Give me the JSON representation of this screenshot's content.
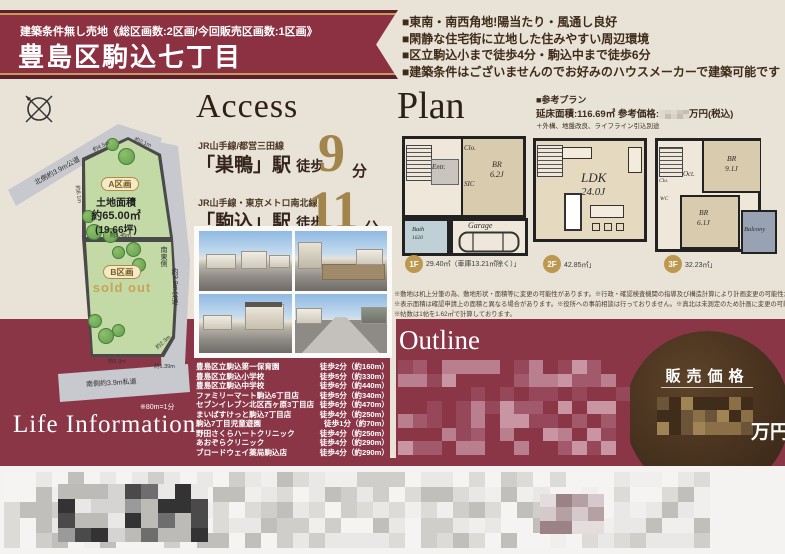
{
  "colors": {
    "maroon": "#8a3647",
    "gold": "#bd9850",
    "beige": "#e9e2d6",
    "text_brown": "#3c2a1d"
  },
  "header": {
    "condition": "建築条件無し売地《総区画数:2区画/今回販売区画数:1区画》",
    "title": "豊島区駒込七丁目"
  },
  "highlights": {
    "items": [
      "■東南・南西角地!陽当たり・風通し良好",
      "■閑静な住宅街に立地した住みやすい周辺環境",
      "■区立駒込小まで徒歩4分・駒込中まで徒歩6分",
      "■建築条件はございませんのでお好みのハウスメーカーで建築可能です"
    ]
  },
  "site_plan": {
    "roads": {
      "north": "北側約3.9m公道",
      "southeast_dir": "南東側",
      "southeast": "約3.8m公道",
      "south": "南側約3.9m私道"
    },
    "plot_a": {
      "badge": "A区画",
      "area_title": "土地面積",
      "area_m2": "約65.00㎡",
      "area_tsubo": "(19.66坪)"
    },
    "plot_b": {
      "badge": "B区画",
      "status": "sold out"
    },
    "dims": {
      "top1": "約4.5m",
      "top2": "約2.1m",
      "left": "約8.1m",
      "divider": "約5.45m",
      "bottom": "約5.3m",
      "corner": "約2.3m",
      "bottom_right": "約1.39m"
    },
    "scale_note": "※80m=1分"
  },
  "access": {
    "title": "Access",
    "stations": [
      {
        "lines": "JR山手線/都営三田線",
        "name": "「巣鴨」駅",
        "walk": "徒歩",
        "minutes": "9",
        "unit": "分"
      },
      {
        "lines": "JR山手線・東京メトロ南北線",
        "name": "「駒込」駅",
        "walk": "徒歩",
        "minutes": "11",
        "unit": "分"
      }
    ]
  },
  "plan": {
    "title": "Plan",
    "reference": {
      "heading": "■参考プラン",
      "area_price": "延床面積:116.69㎡ 参考価格:",
      "price_unit": "万円(税込)",
      "note": "＋外構、地盤改良、ライフライン引込別途"
    },
    "floors": [
      {
        "badge": "1F",
        "area": "29.40㎡（車庫13.21㎡除く）」",
        "rooms": {
          "entr": "Entr.",
          "clo": "Clo.",
          "sic": "SIC",
          "br": "BR",
          "br_size": "6.2J",
          "bath": "Bath",
          "bath_size": "1620",
          "garage": "Garage"
        }
      },
      {
        "badge": "2F",
        "area": "42.85㎡」",
        "rooms": {
          "ldk": "LDK",
          "ldk_size": "24.0J"
        }
      },
      {
        "badge": "3F",
        "area": "32.23㎡」",
        "rooms": {
          "br1": "BR",
          "br1_size": "9.1J",
          "oct": "Oct.",
          "br2": "BR",
          "br2_size": "6.1J",
          "balcony": "Balcony",
          "clo": "Clo.",
          "wc": "WC"
        }
      }
    ],
    "disclaimers": [
      "※敷地は机上分筆の為、敷地形状・面積等に変更の可能性があります。※行政・確認検査機関の指導及び構造計算により計画変更の可能性があります。",
      "※表示面積は確認申請上の面積と異なる場合があります。※役所への事前相談は行っておりません。※真北は未測定のため計画に変更の可能性があります。",
      "※帖数は1帖を1.62㎡で計算しております。"
    ]
  },
  "outline": {
    "title": "Outline"
  },
  "price_circle": {
    "label": "販売価格",
    "unit": "万円"
  },
  "life_information": {
    "title": "Life Information",
    "items": [
      {
        "name": "豊島区立駒込第一保育園",
        "walk": "徒歩2分（約160m）"
      },
      {
        "name": "豊島区立駒込小学校",
        "walk": "徒歩5分（約330m）"
      },
      {
        "name": "豊島区立駒込中学校",
        "walk": "徒歩6分（約440m）"
      },
      {
        "name": "ファミリーマート駒込6丁目店",
        "walk": "徒歩5分（約340m）"
      },
      {
        "name": "セブンイレブン北区西ヶ原3丁目店",
        "walk": "徒歩6分（約470m）"
      },
      {
        "name": "まいばすけっと駒込7丁目店",
        "walk": "徒歩4分（約250m）"
      },
      {
        "name": "駒込7丁目児童遊園",
        "walk": "徒歩1分（約70m）"
      },
      {
        "name": "野田さくらハートクリニック",
        "walk": "徒歩4分（約250m）"
      },
      {
        "name": "あおぞらクリニック",
        "walk": "徒歩4分（約290m）"
      },
      {
        "name": "ブロードウェイ薬局駒込店",
        "walk": "徒歩4分（約290m）"
      }
    ]
  }
}
